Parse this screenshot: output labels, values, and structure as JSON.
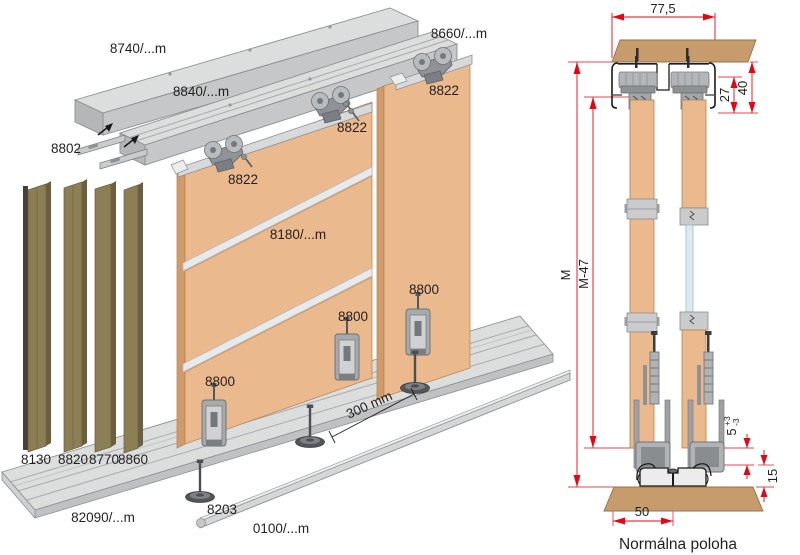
{
  "figure": {
    "type": "sliding-door-system assembly drawing",
    "caption": "Normálna poloha"
  },
  "colors": {
    "panel": "#eab98d",
    "panel_side": "#d09a6b",
    "metal_light": "#dcdddd",
    "metal_mid": "#c6c7c9",
    "metal_dark": "#aaacae",
    "olive": "#8c7e55",
    "olive_dark": "#6b5f40",
    "wood_board": "#c69c6d",
    "glass": "#dcebf3",
    "dimension_red": "#e30613",
    "line": "#231f20"
  },
  "exploded_view": {
    "parts": {
      "top_cover": "8740/...m",
      "double_track": "8840/...m",
      "single_track": "8660/...m",
      "mounting_bracket": "8802",
      "top_roller_1": "8822",
      "top_roller_2": "8822",
      "top_roller_3": "8822",
      "frame_profile": "8180/...m",
      "bottom_roller_1": "8800",
      "bottom_roller_2": "8800",
      "bottom_roller_3": "8800",
      "vertical_profile_1": "8130",
      "vertical_profile_2": "8820",
      "vertical_profile_3": "8770",
      "vertical_profile_4": "8860",
      "bottom_track": "82090/...m",
      "leveling_foot": "8203",
      "guide_rail": "0100/...m"
    },
    "dimensions": {
      "foot_spacing": "300 mm"
    }
  },
  "section_view": {
    "dimensions": {
      "track_width": "77,5",
      "inner_height": "27",
      "total_height": "40",
      "opening_height": "M",
      "door_height": "M-47",
      "bottom_gap": "5",
      "gap_tolerance_plus": "+3",
      "gap_tolerance_minus": "-3",
      "track_height": "15",
      "floor_offset": "50"
    },
    "caption": "Normálna poloha"
  }
}
